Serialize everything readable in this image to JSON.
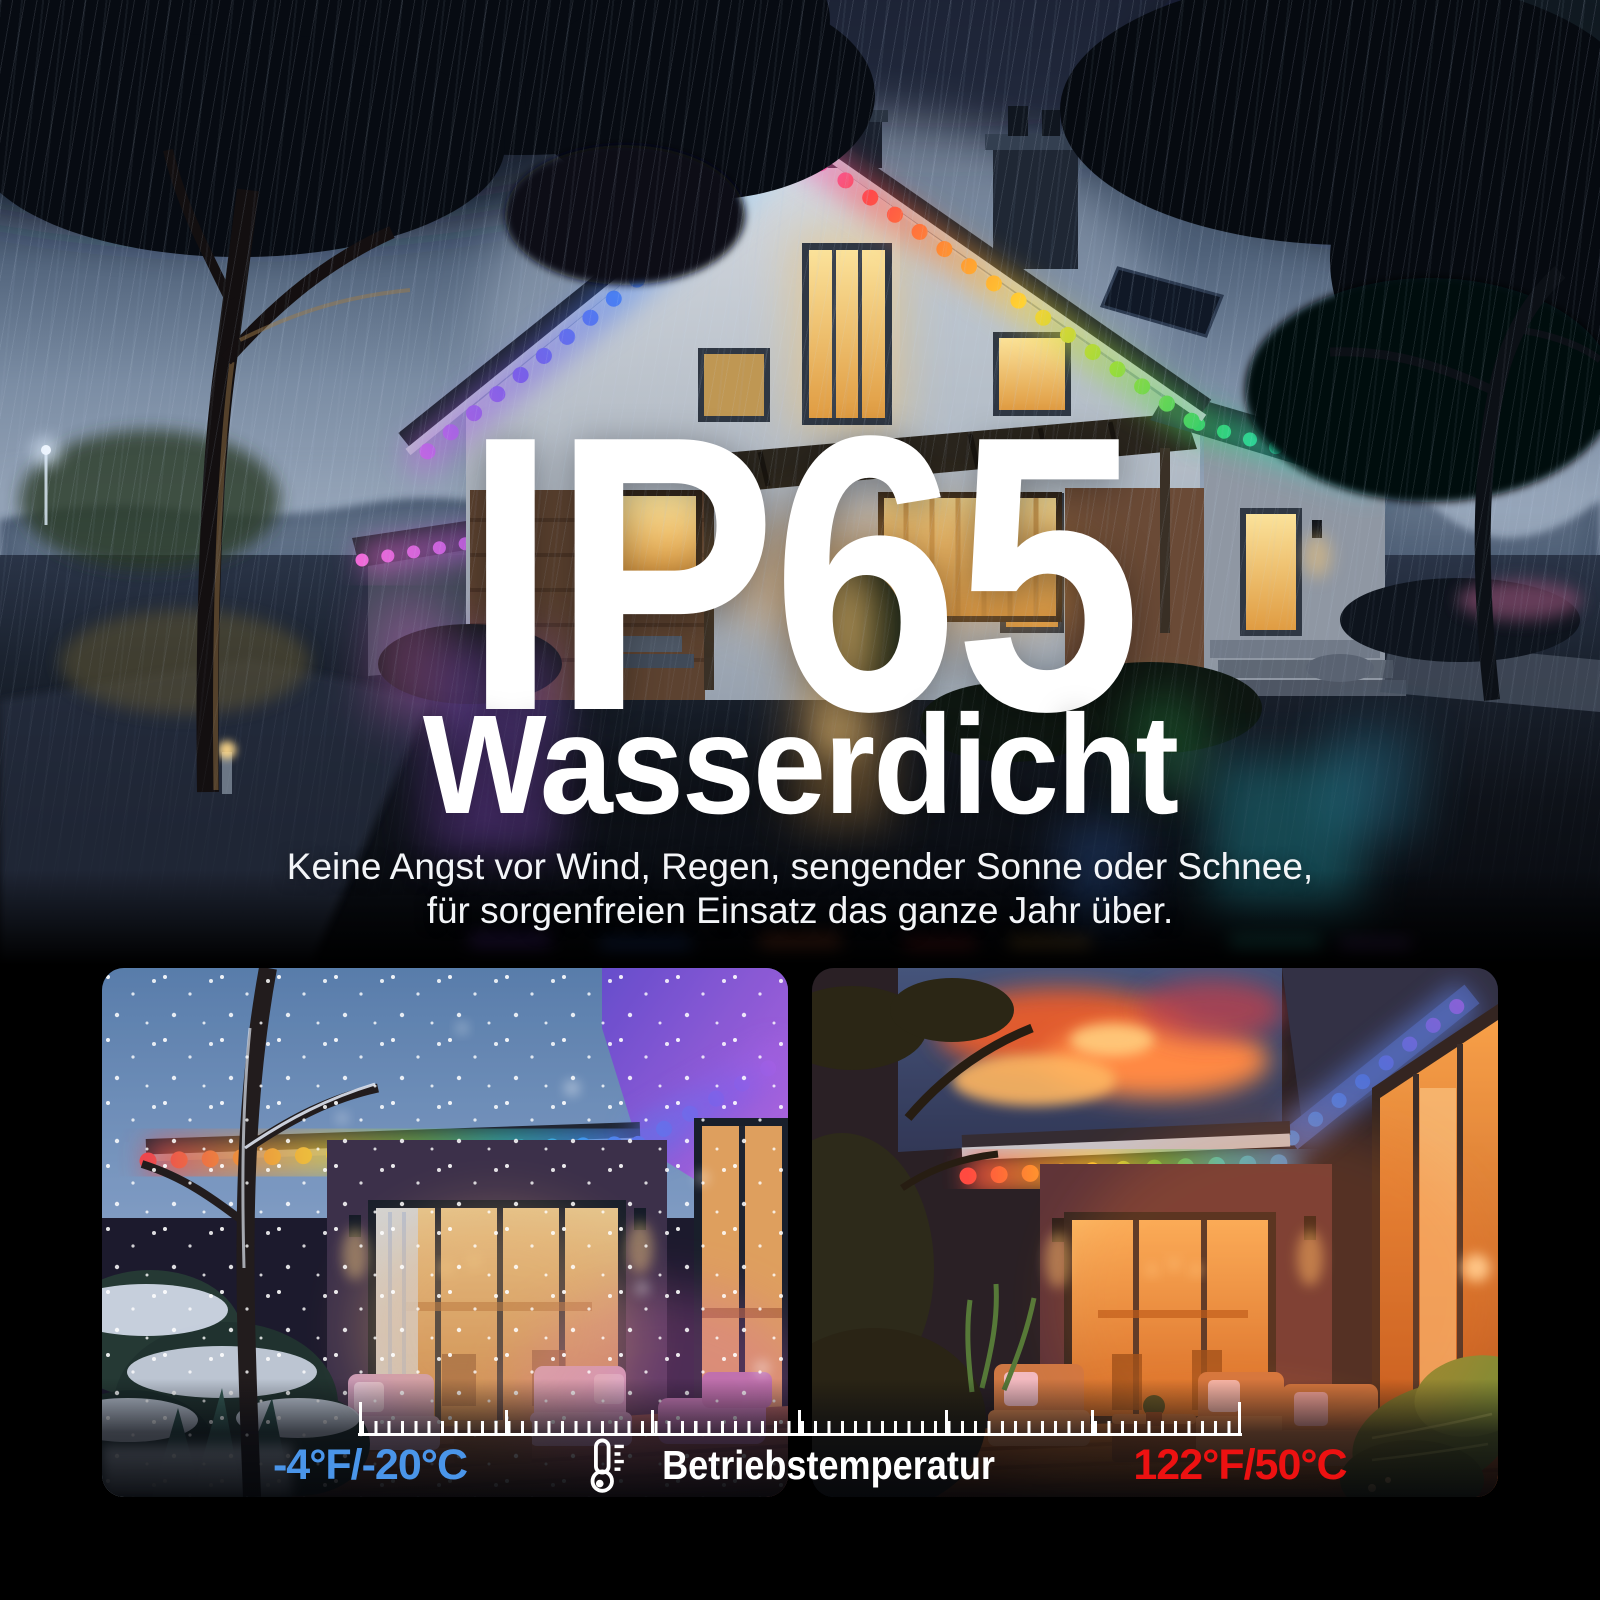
{
  "page": {
    "background_color": "#000000"
  },
  "hero": {
    "title": "IP65",
    "subtitle": "Wasserdicht",
    "description_line1": "Keine Angst vor Wind, Regen, sengender Sonne oder Schnee,",
    "description_line2": "für sorgenfreien Einsatz das ganze Jahr über.",
    "scene_name": "house-in-rain-with-rgb-eave-lights"
  },
  "gallery": {
    "left_scene_name": "winter-snow-patio-with-rgb-lights",
    "right_scene_name": "summer-sunset-patio-with-rgb-lights"
  },
  "temperature_scale": {
    "title": "Betriebstemperatur",
    "low_label": "-4°F/-20°C",
    "high_label": "122°F/50°C",
    "low_color": "#4a95e9",
    "high_color": "#ed1111",
    "tick_color": "#ffffff",
    "icon": "thermometer-icon"
  },
  "accent_colors": {
    "rgb_light_palette": [
      "#ff4545",
      "#ff9232",
      "#ffd232",
      "#58d04a",
      "#2bd4b0",
      "#38b6ff",
      "#5a7df0",
      "#9d64e6",
      "#c668e2"
    ]
  }
}
